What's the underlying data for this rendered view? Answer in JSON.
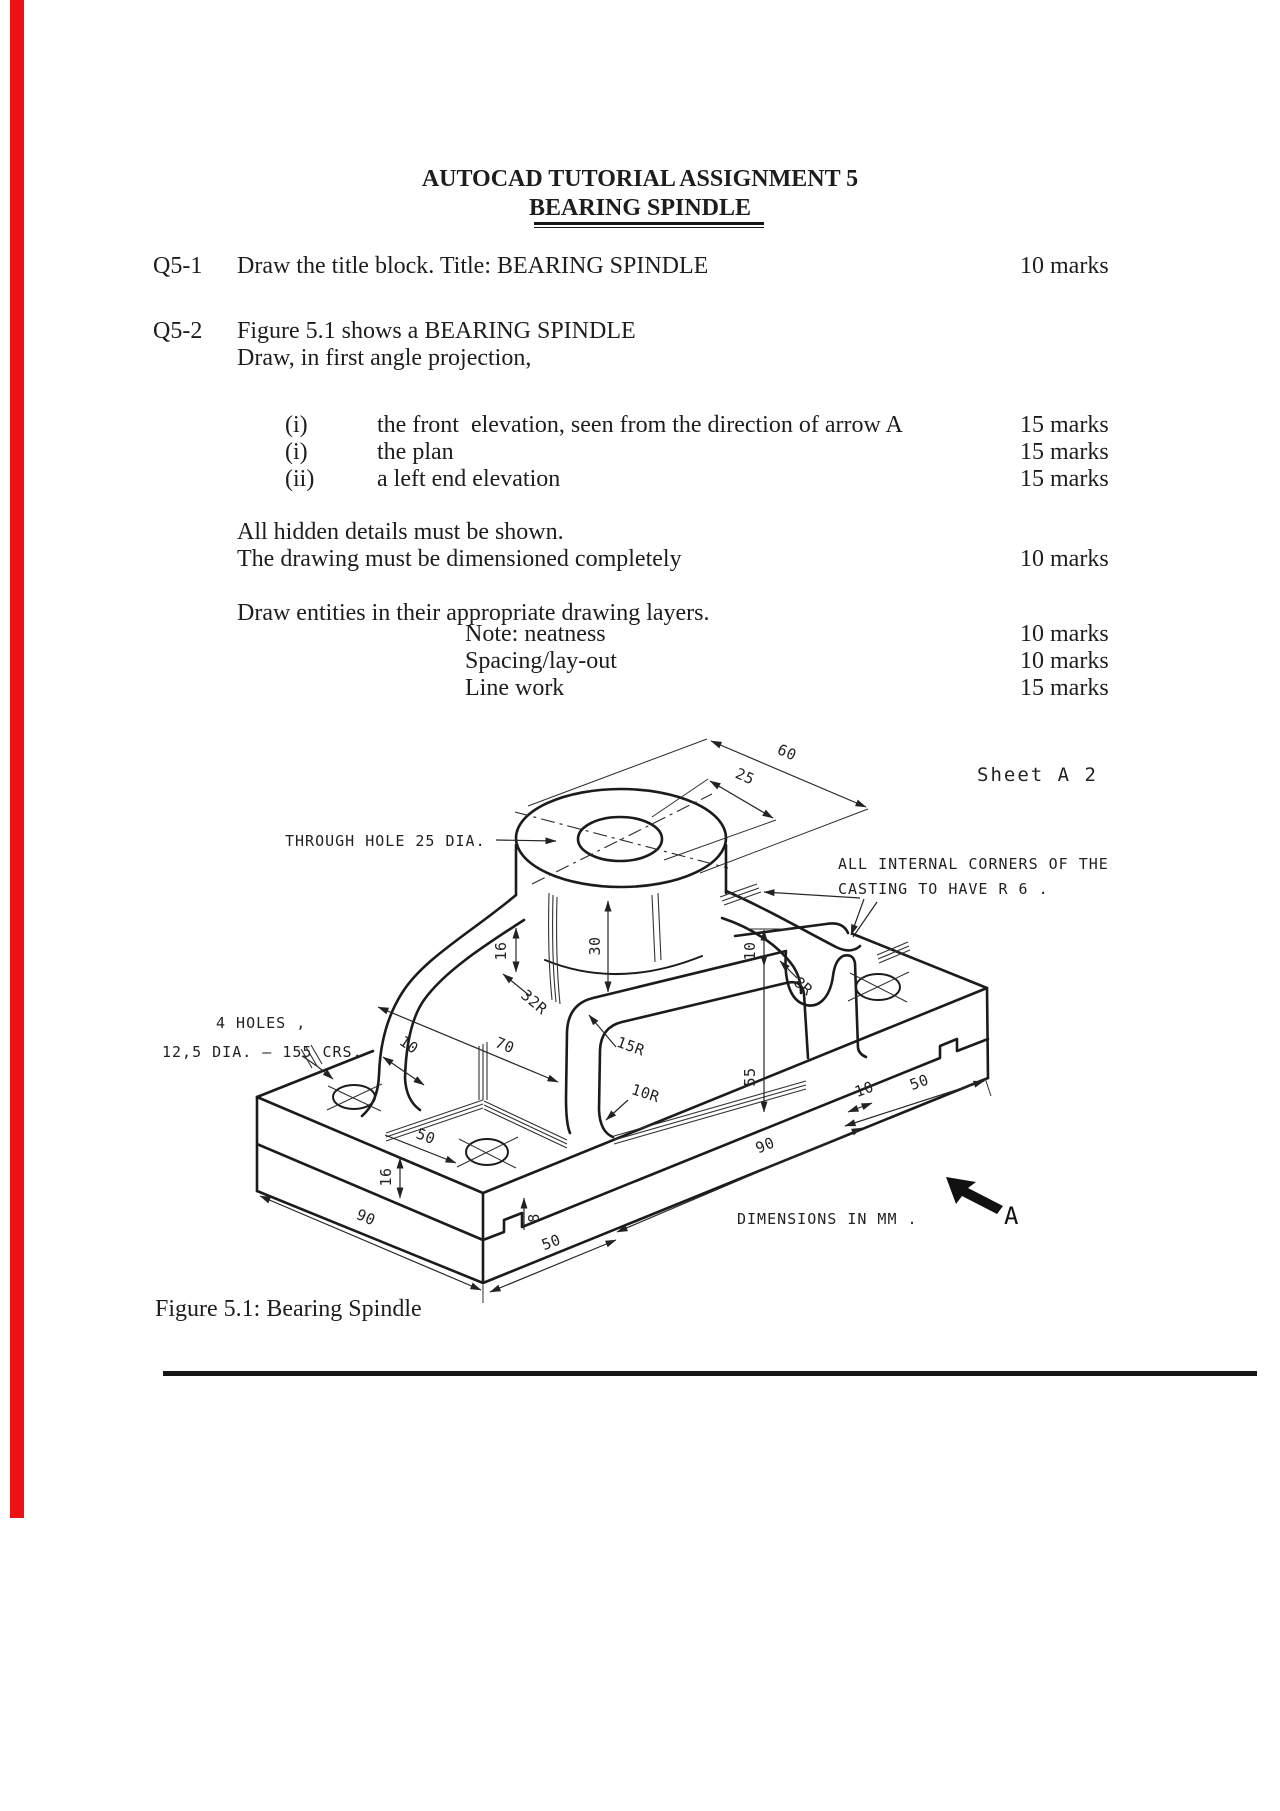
{
  "doc": {
    "title_line1": "AUTOCAD TUTORIAL ASSIGNMENT 5",
    "title_line2": "BEARING SPINDLE",
    "q51": {
      "no": "Q5-1",
      "text": "Draw the title block. Title: BEARING SPINDLE",
      "marks": "10 marks"
    },
    "q52": {
      "no": "Q5-2",
      "intro1": "Figure 5.1 shows a BEARING SPINDLE",
      "intro2": "Draw, in first angle projection,",
      "items": [
        {
          "no": "(i)",
          "text": "the front  elevation, seen from the direction of arrow A",
          "marks": "15 marks"
        },
        {
          "no": "(i)",
          "text": "the plan",
          "marks": "15 marks"
        },
        {
          "no": "(ii)",
          "text": "a left end elevation",
          "marks": "15 marks"
        }
      ],
      "note1": "All hidden details must be shown.",
      "note2": "The drawing must be dimensioned completely",
      "note2_marks": "10 marks",
      "layers": "Draw entities in their appropriate drawing layers.",
      "grading": [
        {
          "label": "Note: neatness",
          "marks": "10 marks"
        },
        {
          "label": "Spacing/lay-out",
          "marks": "10 marks"
        },
        {
          "label": "Line work",
          "marks": "15 marks"
        }
      ]
    },
    "caption": "Figure 5.1: Bearing Spindle"
  },
  "figure": {
    "sheet_label": "Sheet  A 2",
    "ann_through_hole": "THROUGH  HOLE  25 DIA.",
    "ann_corners_line1": "ALL  INTERNAL  CORNERS  OF  THE",
    "ann_corners_line2": "CASTING   TO   HAVE   R 6 .",
    "ann_holes_line1": "4  HOLES ,",
    "ann_holes_line2": "12,5 DIA. —  155 CRS.",
    "ann_dims_mm": "DIMENSIONS   IN   MM .",
    "view_arrow_label": "A",
    "dims": {
      "d60": "60",
      "d25": "25",
      "d30": "30",
      "d16_web": "16",
      "d32r": "32R",
      "d10_web": "10",
      "d70": "70",
      "d15r": "15R",
      "d10r": "10R",
      "d10_top": "10",
      "d55": "55",
      "d8r": "8R",
      "d10_step": "10",
      "d50_right": "50",
      "d90_right": "90",
      "d50_mid": "50",
      "d16_base": "16",
      "d8_notch": "8",
      "d90_left": "90",
      "d50_bottom": "50"
    }
  }
}
